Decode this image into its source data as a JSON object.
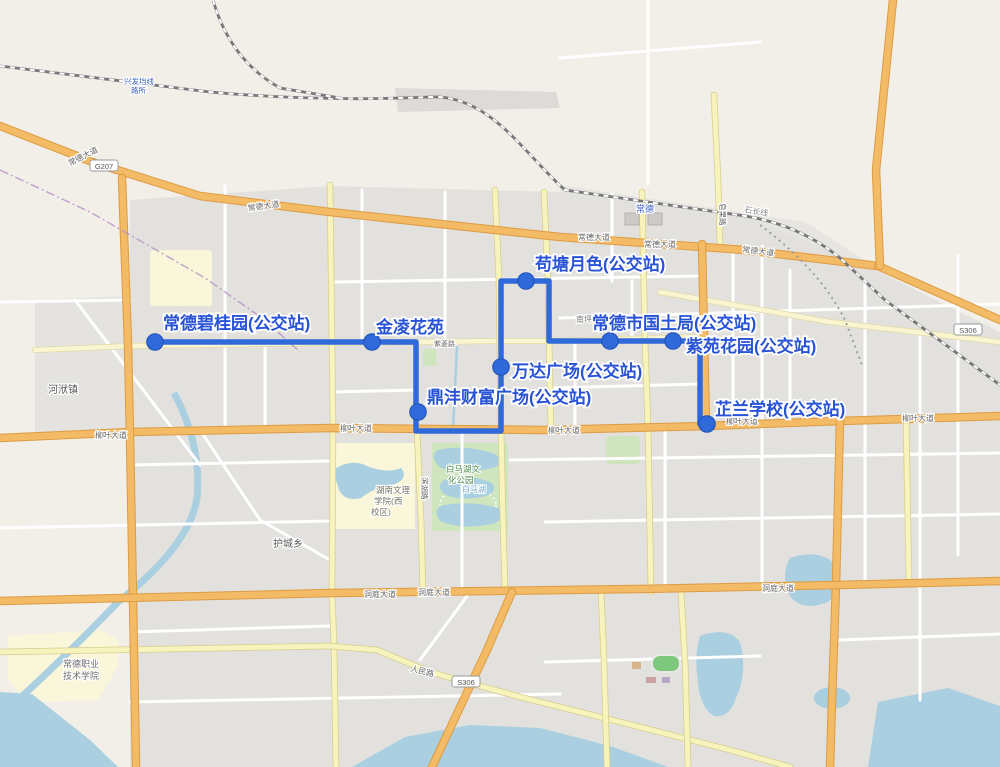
{
  "map": {
    "bus_route": {
      "color": "#3069da",
      "stop_fill": "#3069da",
      "stop_stroke": "#2456b8",
      "label_color": "#2953d6",
      "points": [
        [
          155,
          342
        ],
        [
          416,
          342
        ],
        [
          416,
          431
        ],
        [
          501,
          431
        ],
        [
          501,
          281
        ],
        [
          549,
          281
        ],
        [
          549,
          341
        ],
        [
          700,
          341
        ],
        [
          700,
          424
        ]
      ],
      "stops": [
        {
          "name": "常德碧桂园(公交站)",
          "x": 155,
          "y": 342,
          "label_x": 163,
          "label_y": 329
        },
        {
          "name": "金凌花苑",
          "x": 372,
          "y": 342,
          "label_x": 376,
          "label_y": 333
        },
        {
          "name": "苟塘月色(公交站)",
          "x": 526,
          "y": 281,
          "label_x": 535,
          "label_y": 270
        },
        {
          "name": "常德市国土局(公交站)",
          "x": 610,
          "y": 341,
          "label_x": 592,
          "label_y": 329
        },
        {
          "name": "紫苑花园(公交站)",
          "x": 673,
          "y": 341,
          "label_x": 686,
          "label_y": 352
        },
        {
          "name": "万达广场(公交站)",
          "x": 501,
          "y": 367,
          "label_x": 512,
          "label_y": 377
        },
        {
          "name": "鼎沣财富广场(公交站)",
          "x": 418,
          "y": 412,
          "label_x": 427,
          "label_y": 403
        },
        {
          "name": "芷兰学校(公交站)",
          "x": 707,
          "y": 424,
          "label_x": 715,
          "label_y": 415
        }
      ]
    },
    "place_labels": [
      {
        "text": "河洑镇",
        "x": 48,
        "y": 393,
        "size": 10,
        "color": "#595959",
        "name": "town-label"
      },
      {
        "text": "护城乡",
        "x": 273,
        "y": 547,
        "size": 10,
        "color": "#595959",
        "name": "town-label"
      },
      {
        "text": "常德职业",
        "x": 63,
        "y": 667,
        "size": 9,
        "color": "#6e6e6e",
        "name": "poi-label"
      },
      {
        "text": "技术学院",
        "x": 63,
        "y": 679,
        "size": 9,
        "color": "#6e6e6e",
        "name": "poi-label"
      },
      {
        "text": "湖南文理",
        "x": 376,
        "y": 493,
        "size": 8.5,
        "color": "#77776a",
        "name": "poi-label"
      },
      {
        "text": "学院(西",
        "x": 374,
        "y": 504,
        "size": 8.5,
        "color": "#77776a",
        "name": "poi-label"
      },
      {
        "text": "校区)",
        "x": 371,
        "y": 515,
        "size": 8.5,
        "color": "#77776a",
        "name": "poi-label"
      },
      {
        "text": "白马湖文",
        "x": 446,
        "y": 472,
        "size": 8.5,
        "color": "#4c8c4c",
        "name": "park-label"
      },
      {
        "text": "化公园",
        "x": 448,
        "y": 483,
        "size": 8.5,
        "color": "#4c8c4c",
        "name": "park-label"
      },
      {
        "text": "白马湖",
        "x": 462,
        "y": 492,
        "size": 8,
        "color": "#74a9c8",
        "name": "water-label"
      },
      {
        "text": "南坪",
        "x": 576,
        "y": 322,
        "size": 8,
        "color": "#777777",
        "name": "district-label"
      },
      {
        "text": "常德",
        "x": 636,
        "y": 212,
        "size": 9,
        "color": "#3c5fc0",
        "name": "station-label"
      },
      {
        "text": "兴发垱线",
        "x": 124,
        "y": 84,
        "size": 7.5,
        "color": "#3c5fc0",
        "name": "station-label"
      },
      {
        "text": "路所",
        "x": 131,
        "y": 93,
        "size": 7.5,
        "color": "#3c5fc0",
        "name": "station-label"
      },
      {
        "text": "石长线",
        "x": 744,
        "y": 212,
        "size": 8,
        "color": "#8a8a8a",
        "rotate": 10,
        "name": "railway-label"
      },
      {
        "text": "常德大道",
        "x": 70,
        "y": 166,
        "size": 8,
        "color": "#666666",
        "rotate": -27,
        "name": "road-label"
      },
      {
        "text": "常德大道",
        "x": 248,
        "y": 211,
        "size": 8,
        "color": "#666666",
        "rotate": -8,
        "name": "road-label"
      },
      {
        "text": "常德大道",
        "x": 578,
        "y": 240,
        "size": 8,
        "color": "#666666",
        "name": "road-label"
      },
      {
        "text": "常德大道",
        "x": 644,
        "y": 247,
        "size": 8,
        "color": "#666666",
        "name": "road-label"
      },
      {
        "text": "常德大道",
        "x": 742,
        "y": 252,
        "size": 8,
        "color": "#666666",
        "rotate": 7,
        "name": "road-label"
      },
      {
        "text": "柳叶大道",
        "x": 95,
        "y": 438,
        "size": 8,
        "color": "#666666",
        "name": "road-label"
      },
      {
        "text": "柳叶大道",
        "x": 340,
        "y": 431,
        "size": 8,
        "color": "#666666",
        "name": "road-label"
      },
      {
        "text": "柳叶大道",
        "x": 548,
        "y": 433,
        "size": 8,
        "color": "#666666",
        "name": "road-label"
      },
      {
        "text": "柳叶大道",
        "x": 726,
        "y": 424,
        "size": 8,
        "color": "#666666",
        "name": "road-label"
      },
      {
        "text": "柳叶大道",
        "x": 902,
        "y": 421,
        "size": 8,
        "color": "#666666",
        "name": "road-label"
      },
      {
        "text": "洞庭大道",
        "x": 364,
        "y": 597,
        "size": 8,
        "color": "#666666",
        "name": "road-label"
      },
      {
        "text": "洞庭大道",
        "x": 418,
        "y": 595,
        "size": 8,
        "color": "#666666",
        "name": "road-label"
      },
      {
        "text": "洞庭大道",
        "x": 762,
        "y": 591,
        "size": 8,
        "color": "#666666",
        "name": "road-label"
      },
      {
        "text": "人民路",
        "x": 410,
        "y": 671,
        "size": 8,
        "color": "#666666",
        "rotate": 14,
        "name": "road-label"
      },
      {
        "text": "紫菱路",
        "x": 434,
        "y": 346,
        "size": 7,
        "color": "#666666",
        "name": "road-label"
      },
      {
        "text": "皂果路",
        "x": 720,
        "y": 203,
        "size": 7.5,
        "color": "#666666",
        "rotate": 90,
        "name": "road-label"
      },
      {
        "text": "滨湖路",
        "x": 422,
        "y": 477,
        "size": 7.5,
        "color": "#666666",
        "rotate": 90,
        "name": "road-label"
      }
    ],
    "road_shields": [
      {
        "text": "G207",
        "x": 104,
        "y": 168
      },
      {
        "text": "S306",
        "x": 466,
        "y": 684
      },
      {
        "text": "S306",
        "x": 968,
        "y": 332
      }
    ]
  }
}
